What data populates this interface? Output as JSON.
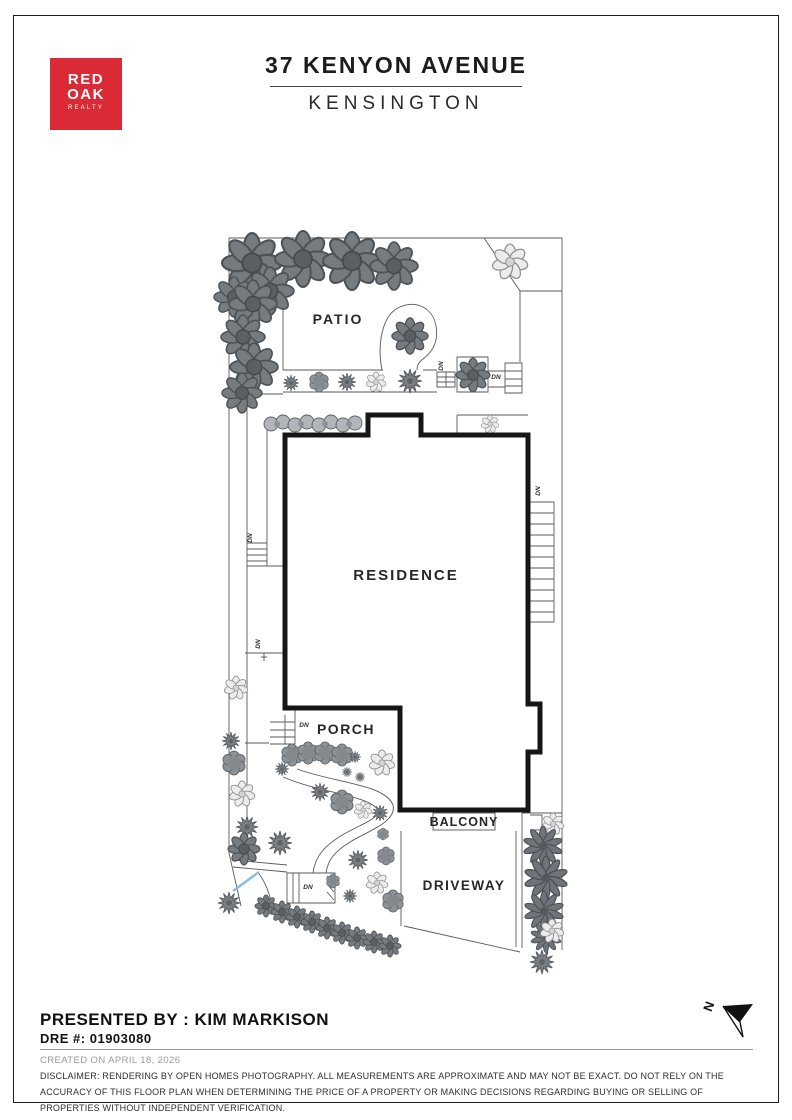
{
  "header": {
    "logo_line1": "RED",
    "logo_line2": "OAK",
    "logo_line3": "REALTY",
    "title": "37 KENYON AVENUE",
    "subtitle": "KENSINGTON"
  },
  "plan": {
    "patio": "PATIO",
    "residence": "RESIDENCE",
    "porch": "PORCH",
    "balcony": "BALCONY",
    "driveway": "DRIVEWAY",
    "dn": "DN",
    "north": "N"
  },
  "footer": {
    "presented_by": "PRESENTED BY : KIM MARKISON",
    "dre": "DRE #: 01903080",
    "created": "CREATED ON APRIL 18, 2026",
    "disclaimer": "DISCLAIMER: RENDERING BY OPEN HOMES PHOTOGRAPHY. ALL MEASUREMENTS ARE APPROXIMATE AND MAY NOT BE EXACT. DO NOT RELY ON THE ACCURACY OF THIS FLOOR PLAN WHEN DETERMINING THE PRICE OF A PROPERTY OR MAKING DECISIONS REGARDING BUYING OR SELLING OF PROPERTIES WITHOUT INDEPENDENT VERIFICATION."
  },
  "colors": {
    "brand_red": "#d92a35",
    "wall_black": "#161616",
    "line_gray": "#5a5a5a",
    "accent_blue": "#85bde4"
  }
}
